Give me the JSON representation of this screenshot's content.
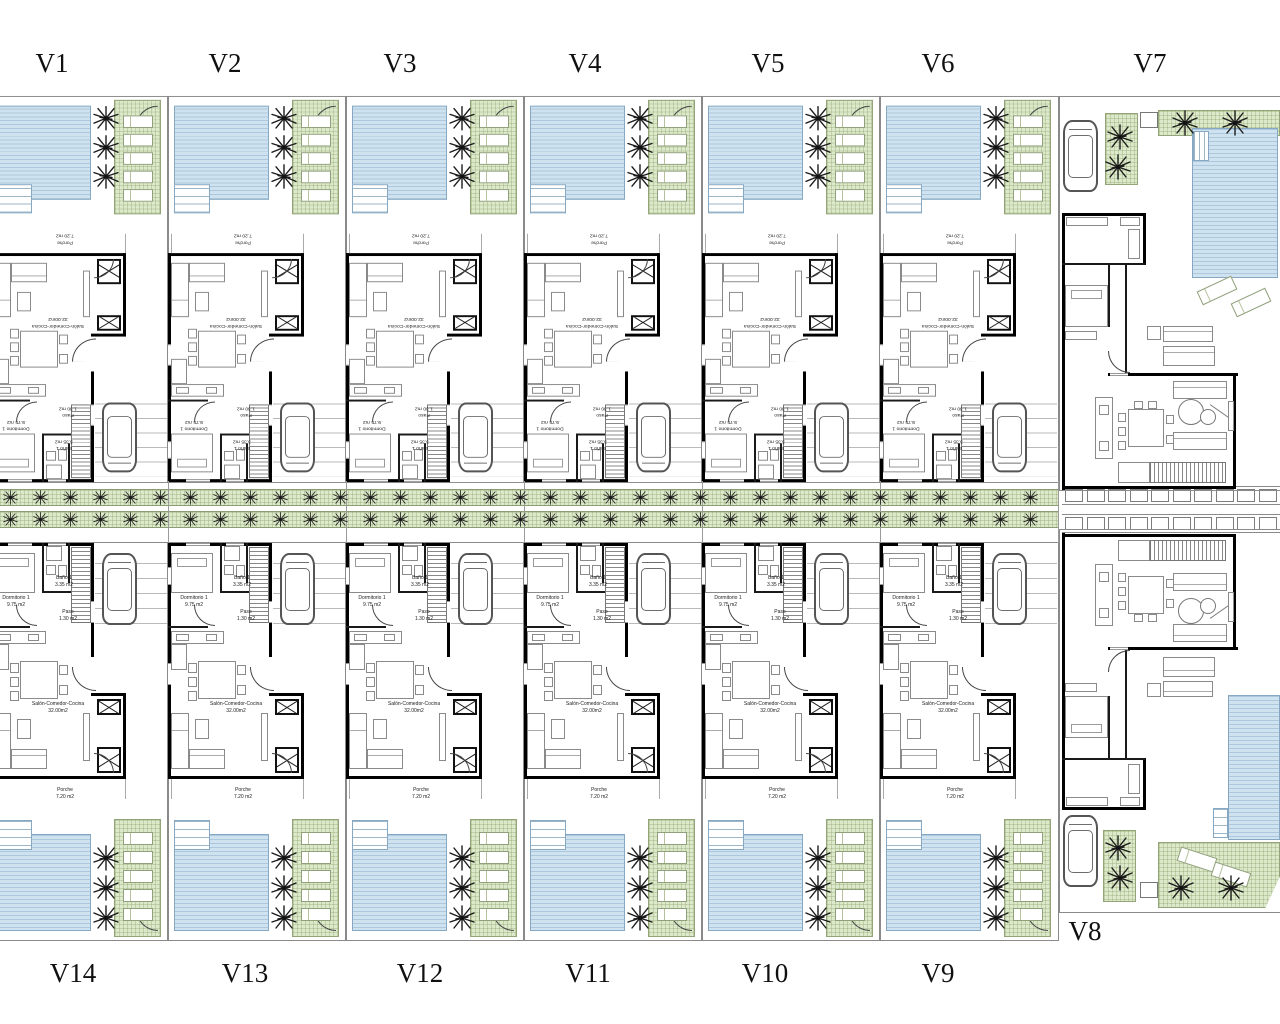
{
  "units": {
    "top_row": [
      "V1",
      "V2",
      "V3",
      "V4",
      "V5",
      "V6"
    ],
    "bottom_row": [
      "V14",
      "V13",
      "V12",
      "V11",
      "V10",
      "V9"
    ],
    "right_top": "V7",
    "right_bottom": "V8"
  },
  "room_labels": {
    "salon": {
      "name": "Salón-Comedor-Cocina",
      "area": "32.00m2"
    },
    "dormitorio": {
      "name": "Dormitorio 1",
      "area": "9.75 m2"
    },
    "bano": {
      "name": "Baño 1",
      "area": "3.35 m2"
    },
    "paso": {
      "name": "Paso",
      "area": "1.30 m2"
    },
    "porche": {
      "name": "Porche",
      "area": "7.20 m2"
    }
  },
  "colors": {
    "pool": "#cfe2ef",
    "pool_border": "#86a8c2",
    "lawn": "#dde9cb",
    "lawn_border": "#93a478",
    "wall": "#000000"
  }
}
